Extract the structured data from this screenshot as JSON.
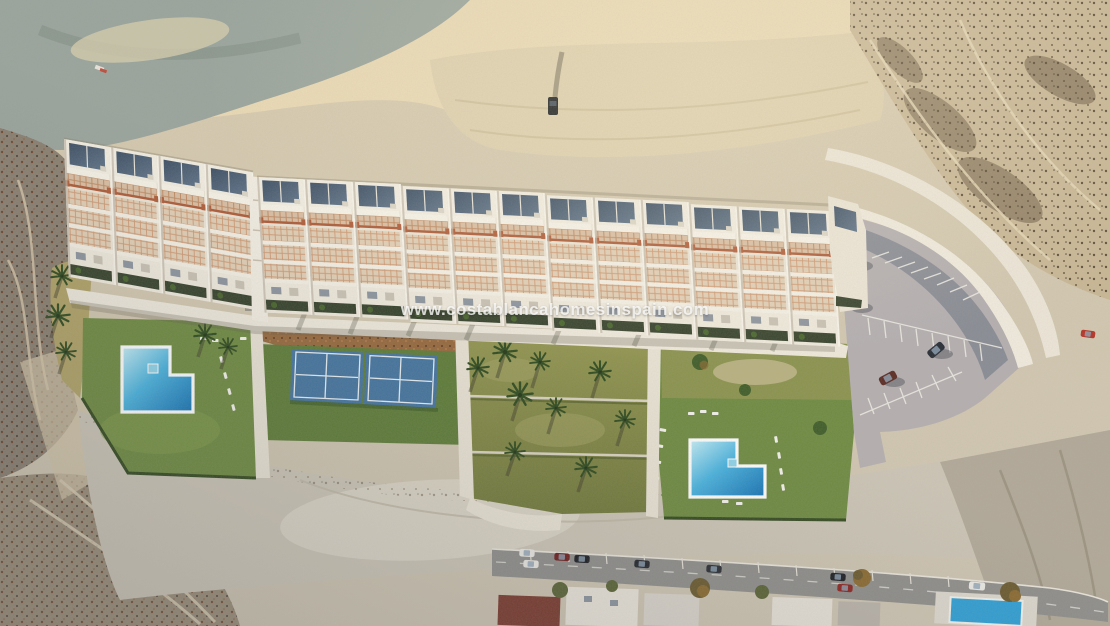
{
  "image": {
    "kind": "aerial 3D render",
    "subject": "new-build terraced apartment complex with gardens, two pools, padel courts and private parking on an arid hillside",
    "watermark": "www.costablancahomesinspain.com"
  },
  "scene": {
    "development": {
      "wings": 2,
      "townhouse_units": 16,
      "pools": 2,
      "padel_courts": 2,
      "parking_cars": 4
    },
    "surroundings": {
      "top": "sandy ridge with dirt track and one parked car",
      "left": "dark scrub slope with winding trails",
      "right": "eroded ravines and scrub, red car on track",
      "bottom": "existing street with parked cars, house roofs and a small neighbour pool"
    }
  },
  "colors": {
    "sand": "#d3c6a9",
    "sand_bright": "#ead9b4",
    "rock": "#99a49c",
    "slope": "#8a7f70",
    "waste": "#ccc5b6",
    "building": "#ece5d6",
    "roof_panel": "#46586c",
    "terracotta": "#ad5a36",
    "planter": "#35412b",
    "lawn": "#6e8a40",
    "olive_top": "#8f9350",
    "mulch": "#96683c",
    "court": "#44749f",
    "court_surround": "#5e7c37",
    "pool_light": "#c2ecf4",
    "pool_deep": "#1a7fc0",
    "parking": "#b4aeb0",
    "wall": "#f1ebde",
    "road": "#8f8e8b"
  }
}
